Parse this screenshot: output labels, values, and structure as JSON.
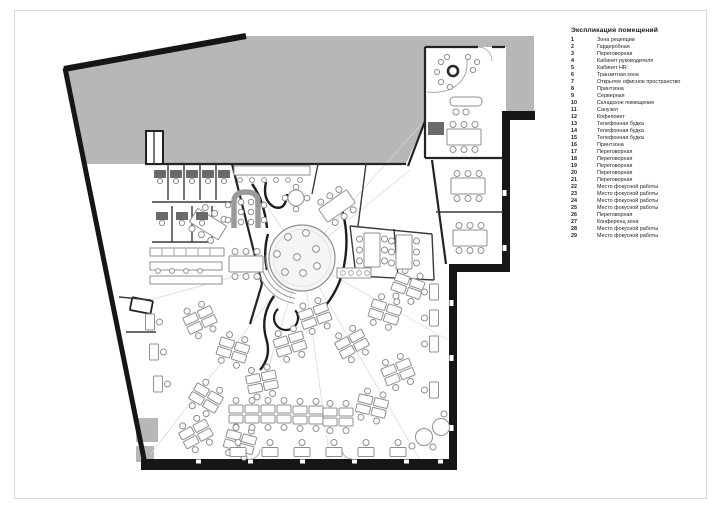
{
  "colors": {
    "site_gray": "#b7b7b7",
    "wall_black": "#161616",
    "furniture_gray": "#8f8f8f",
    "page_border": "#d9d9d9",
    "text_color": "#1c1c1c"
  },
  "legend": {
    "title": "Экспликация помещений",
    "items": [
      {
        "num": "1",
        "label": "Зона рецепции"
      },
      {
        "num": "2",
        "label": "Гардеробная"
      },
      {
        "num": "3",
        "label": "Переговорная"
      },
      {
        "num": "4",
        "label": "Кабинет руководителя"
      },
      {
        "num": "5",
        "label": "Кабинет HR"
      },
      {
        "num": "6",
        "label": "Транзитная зона"
      },
      {
        "num": "7",
        "label": "Открытое офисное пространство"
      },
      {
        "num": "8",
        "label": "Принтзона"
      },
      {
        "num": "9",
        "label": "Серверная"
      },
      {
        "num": "10",
        "label": "Складское помещение"
      },
      {
        "num": "11",
        "label": "Санузел"
      },
      {
        "num": "12",
        "label": "Кофепоинт"
      },
      {
        "num": "13",
        "label": "Телефонная будка"
      },
      {
        "num": "14",
        "label": "Телефонная будка"
      },
      {
        "num": "15",
        "label": "Телефонная будка"
      },
      {
        "num": "16",
        "label": "Принтзона"
      },
      {
        "num": "17",
        "label": "Переговорная"
      },
      {
        "num": "18",
        "label": "Переговорная"
      },
      {
        "num": "19",
        "label": "Переговорная"
      },
      {
        "num": "20",
        "label": "Переговорная"
      },
      {
        "num": "21",
        "label": "Переговорная"
      },
      {
        "num": "22",
        "label": "Место фокусной работы"
      },
      {
        "num": "23",
        "label": "Место фокусной работы"
      },
      {
        "num": "24",
        "label": "Место фокусной работы"
      },
      {
        "num": "25",
        "label": "Место фокусной работы"
      },
      {
        "num": "26",
        "label": "Переговорная"
      },
      {
        "num": "27",
        "label": "Конференц зона"
      },
      {
        "num": "28",
        "label": "Место фокусной работы"
      },
      {
        "num": "29",
        "label": "Место фокусной работы"
      }
    ]
  }
}
